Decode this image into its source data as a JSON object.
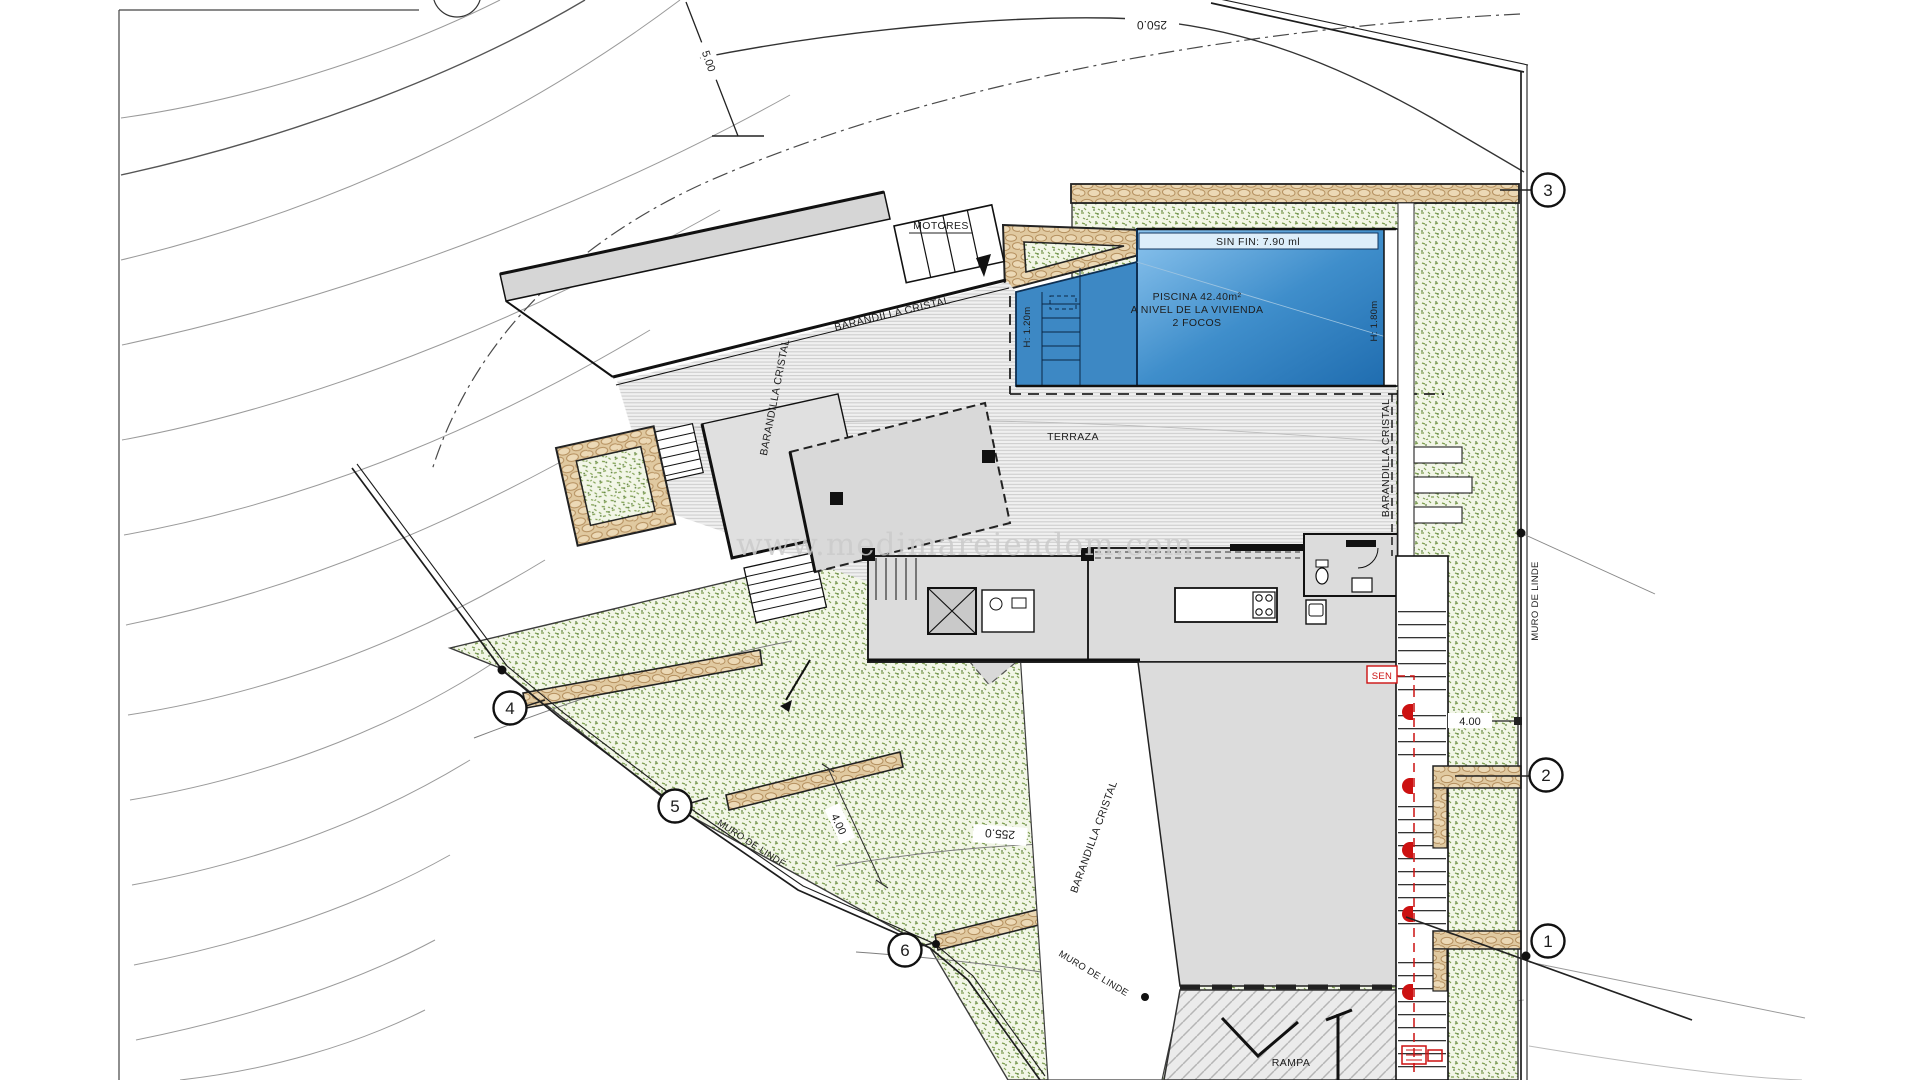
{
  "site_plan": {
    "watermark": "www.medimareiendom.com",
    "pool": {
      "edge_label": "SIN FIN: 7.90 ml",
      "title": "PISCINA 42.40m²",
      "subtitle": "A NIVEL DE LA VIVIENDA",
      "note": "2 FOCOS",
      "depth_deep": "H: 1.80m",
      "depth_shallow": "H: 1.20m"
    },
    "areas": {
      "terrace": "TERRAZA",
      "ramp": "RAMPA",
      "motors": "MOTORES"
    },
    "railings": {
      "glass": "BARANDILLA CRISTAL"
    },
    "boundary": {
      "wall": "MURO DE LINDE",
      "sensor": "SEN"
    },
    "contours": {
      "upper": "250.0",
      "lower": "255.0"
    },
    "dimensions": {
      "offset_top": "5.00",
      "offset_right": "4.00",
      "offset_garden": "4.00"
    },
    "markers": [
      "1",
      "2",
      "3",
      "4",
      "5",
      "6"
    ],
    "colors": {
      "pool_deep": "#1e6bae",
      "pool_light": "#8cc4ee",
      "garden_green": "#7d9c52",
      "wall_stone": "#e0c9a0",
      "alert_red": "#cc1111"
    }
  }
}
